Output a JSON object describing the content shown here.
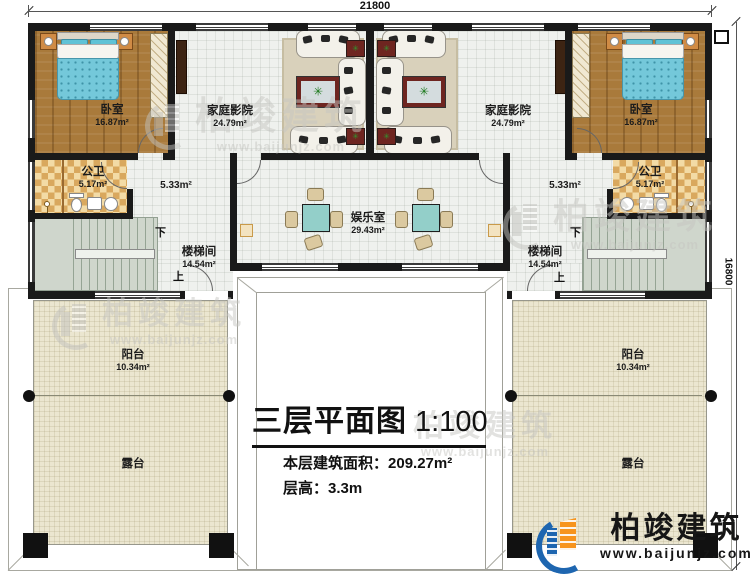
{
  "dimensions": {
    "top": "21800",
    "right": "16800"
  },
  "rooms": {
    "bedroom_left": {
      "name": "卧室",
      "area": "16.87m²"
    },
    "bedroom_right": {
      "name": "卧室",
      "area": "16.87m²"
    },
    "home_theater_left": {
      "name": "家庭影院",
      "area": "24.79m²"
    },
    "home_theater_right": {
      "name": "家庭影院",
      "area": "24.79m²"
    },
    "bath_left": {
      "name": "公卫",
      "area": "5.17m²"
    },
    "bath_right": {
      "name": "公卫",
      "area": "5.17m²"
    },
    "hall_left": {
      "area": "5.33m²"
    },
    "hall_right": {
      "area": "5.33m²"
    },
    "entertainment": {
      "name": "娱乐室",
      "area": "29.43m²"
    },
    "stairwell_left": {
      "name": "楼梯间",
      "area": "14.54m²",
      "up": "上",
      "down": "下"
    },
    "stairwell_right": {
      "name": "楼梯间",
      "area": "14.54m²",
      "up": "上",
      "down": "下"
    },
    "balcony_left": {
      "name": "阳台",
      "area": "10.34m²"
    },
    "balcony_right": {
      "name": "阳台",
      "area": "10.34m²"
    },
    "terrace_left": {
      "name": "露台"
    },
    "terrace_right": {
      "name": "露台"
    }
  },
  "title_block": {
    "title": "三层平面图",
    "scale": "1:100",
    "area_label": "本层建筑面积：",
    "area_value": "209.27m²",
    "height_label": "层高：",
    "height_value": "3.3m"
  },
  "brand": {
    "name": "柏竣建筑",
    "url": "www.baijunjz.com"
  },
  "watermark": {
    "name": "柏竣建筑",
    "url": "www.baijunjz.com"
  },
  "colors": {
    "wall": "#1a1a1a",
    "wood_floor": "#a97a3b",
    "checker_tile": "#d9a85e",
    "stair": "#cfd6cc",
    "terrace": "#ebe6d0",
    "table_teal": "#93cfc9",
    "bed_teal": "#74c8da",
    "accent_red": "#6e2520",
    "brand_blue": "#1e66b0",
    "brand_orange": "#f7941d"
  }
}
